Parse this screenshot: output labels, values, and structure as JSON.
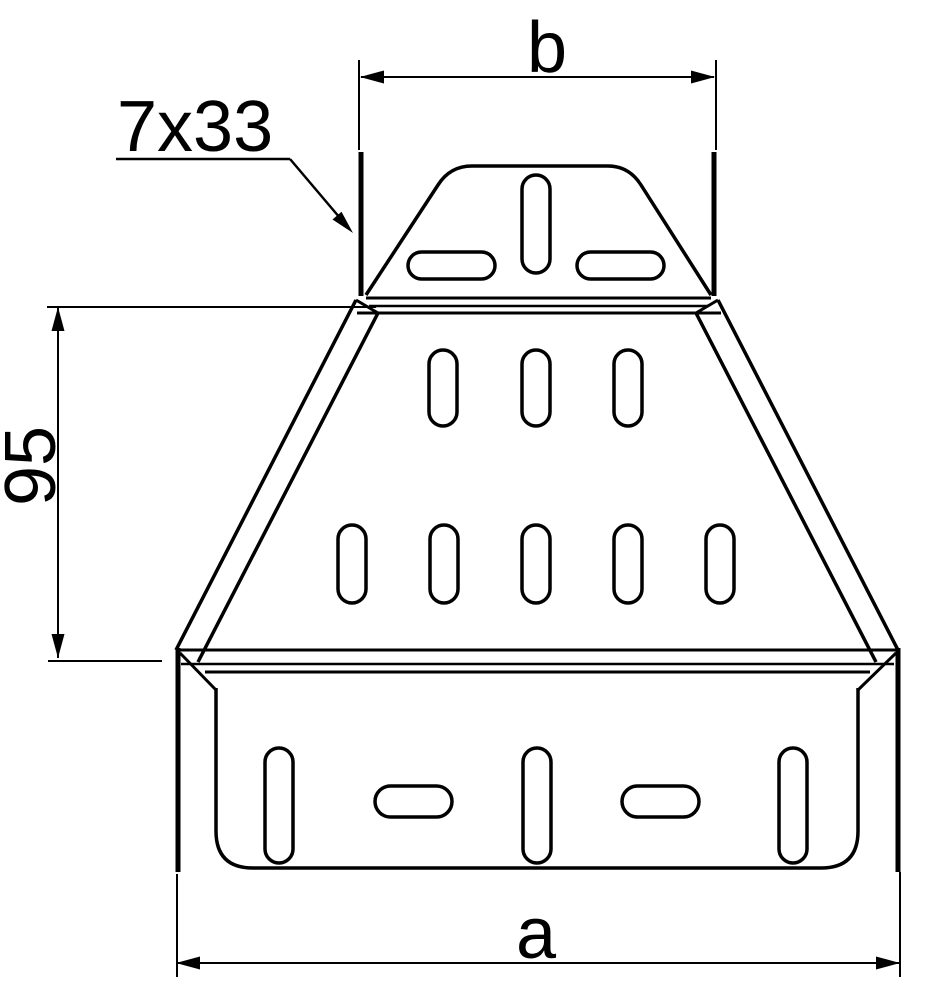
{
  "drawing": {
    "labels": {
      "top_width": "b",
      "bottom_width": "a",
      "side_height": "95",
      "slot_spec": "7x33"
    },
    "colors": {
      "line": "#000000",
      "background": "#ffffff"
    },
    "features": {
      "top_connector_slots_vertical": 1,
      "top_connector_slots_horizontal": 2,
      "body_slot_row_upper_count": 3,
      "body_slot_row_lower_count": 5,
      "base_slots_vertical": 3,
      "base_slots_horizontal": 2
    }
  }
}
